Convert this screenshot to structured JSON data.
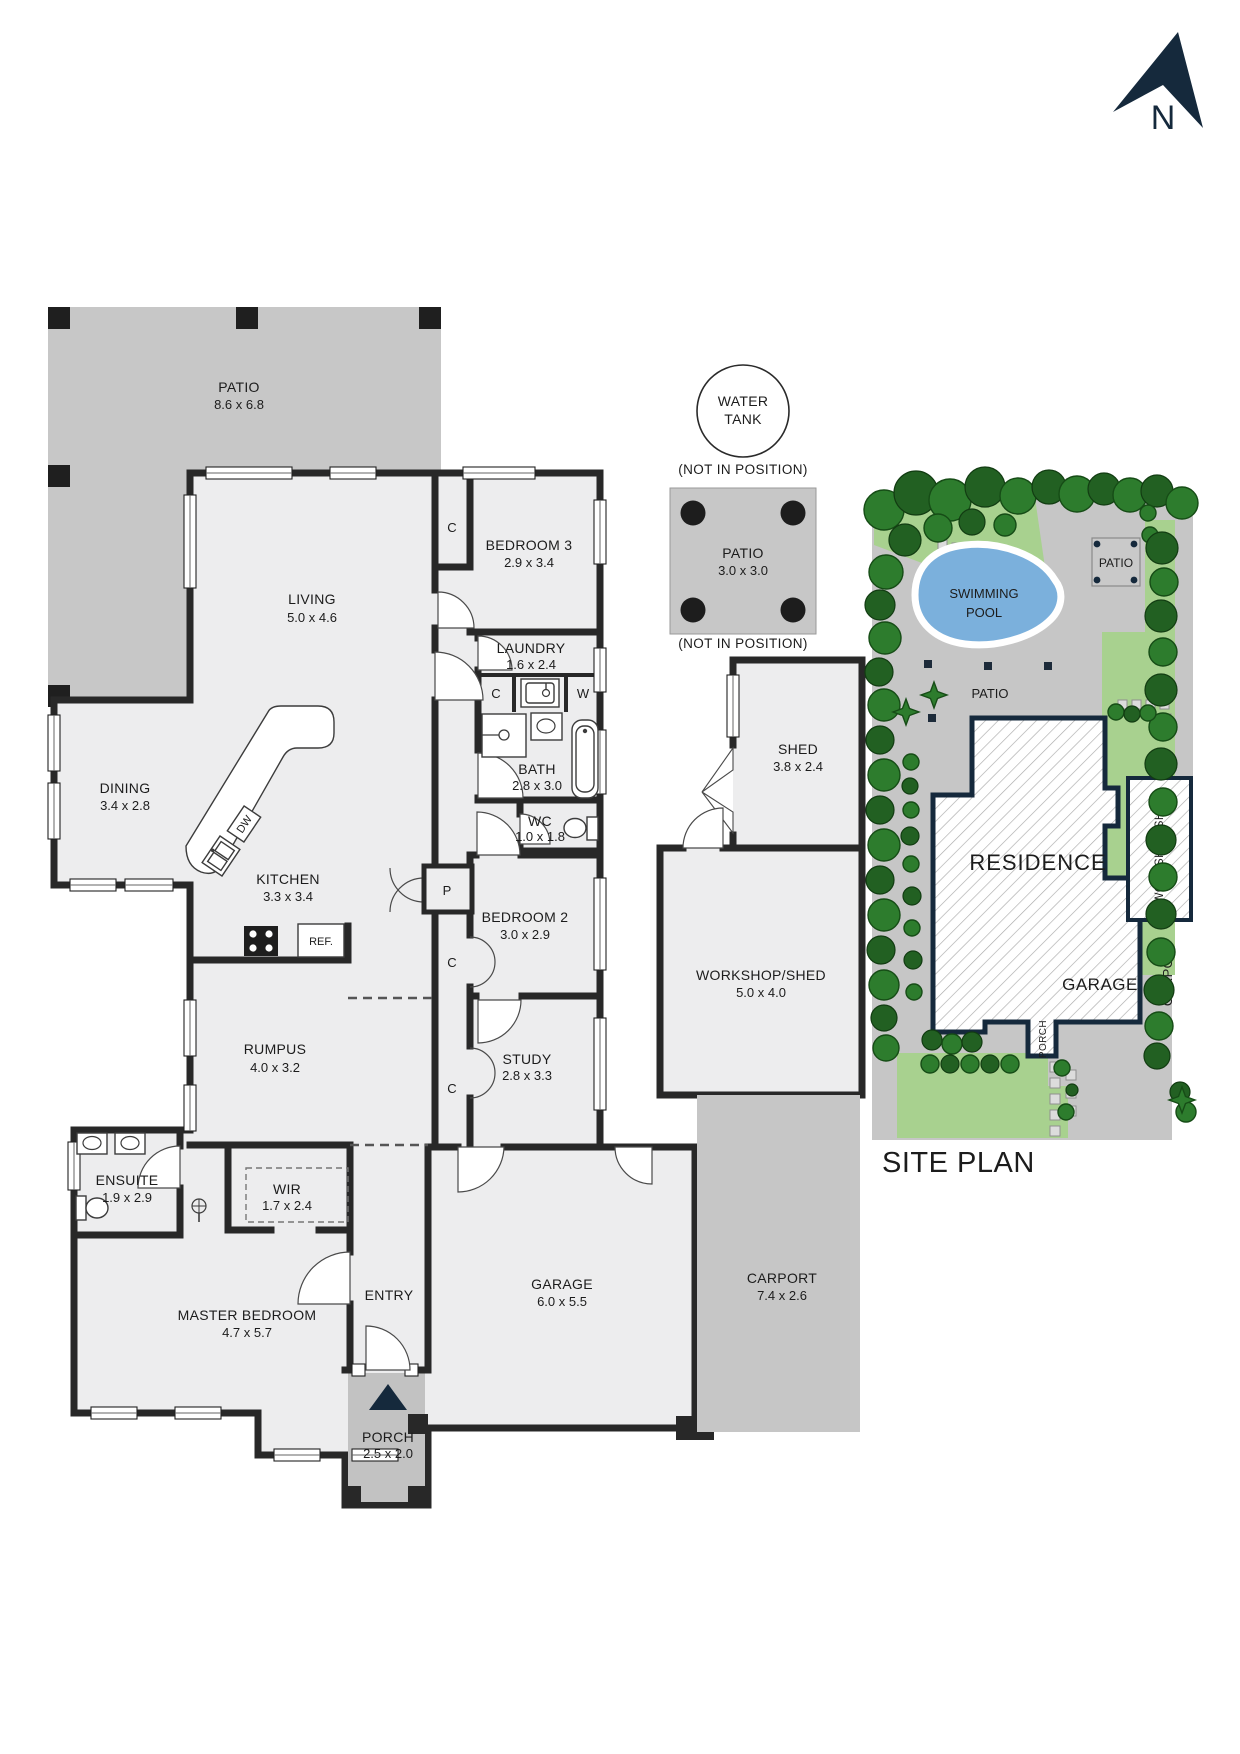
{
  "north": {
    "label": "N"
  },
  "floor_plan": {
    "rooms": {
      "patio_main": {
        "name": "PATIO",
        "dims": "8.6 x 6.8"
      },
      "living": {
        "name": "LIVING",
        "dims": "5.0 x 4.6"
      },
      "bedroom3": {
        "name": "BEDROOM 3",
        "dims": "2.9 x 3.4"
      },
      "laundry": {
        "name": "LAUNDRY",
        "dims": "1.6 x 2.4"
      },
      "dining": {
        "name": "DINING",
        "dims": "3.4 x 2.8"
      },
      "bath": {
        "name": "BATH",
        "dims": "2.8 x 3.0"
      },
      "wc": {
        "name": "WC",
        "dims": "1.0 x 1.8"
      },
      "kitchen": {
        "name": "KITCHEN",
        "dims": "3.3 x 3.4"
      },
      "bedroom2": {
        "name": "BEDROOM 2",
        "dims": "3.0 x 2.9"
      },
      "rumpus": {
        "name": "RUMPUS",
        "dims": "4.0 x 3.2"
      },
      "study": {
        "name": "STUDY",
        "dims": "2.8 x 3.3"
      },
      "ensuite": {
        "name": "ENSUITE",
        "dims": "1.9 x 2.9"
      },
      "wir": {
        "name": "WIR",
        "dims": "1.7 x 2.4"
      },
      "master_bedroom": {
        "name": "MASTER BEDROOM",
        "dims": "4.7 x 5.7"
      },
      "entry": {
        "name": "ENTRY"
      },
      "garage": {
        "name": "GARAGE",
        "dims": "6.0 x 5.5"
      },
      "porch": {
        "name": "PORCH",
        "dims": "2.5 x 2.0"
      },
      "shed": {
        "name": "SHED",
        "dims": "3.8 x 2.4"
      },
      "workshop_shed": {
        "name": "WORKSHOP/SHED",
        "dims": "5.0 x 4.0"
      },
      "carport": {
        "name": "CARPORT",
        "dims": "7.4 x 2.6"
      }
    },
    "fixtures": {
      "closet": "C",
      "washer": "W",
      "pantry": "P",
      "dishwasher": "DW",
      "refrigerator": "REF."
    },
    "water_tank": {
      "line1": "WATER",
      "line2": "TANK",
      "note": "(NOT IN POSITION)"
    },
    "patio_detached": {
      "name": "PATIO",
      "dims": "3.0 x 3.0",
      "note": "(NOT IN POSITION)"
    }
  },
  "site_plan": {
    "title": "SITE PLAN",
    "residence": "RESIDENCE",
    "garage": "GARAGE",
    "workshop_shed": "WORKSHOP/SHED",
    "carport": "CARPORT",
    "porch": "PORCH",
    "swimming_pool": {
      "line1": "SWIMMING",
      "line2": "POOL"
    },
    "patio_rear": "PATIO",
    "patio_court": "PATIO"
  },
  "colors": {
    "wall": "#282828",
    "room_fill": "#ededee",
    "patio_gray": "#c7c7c7",
    "navy": "#15293c",
    "pool_blue": "#7bb0dc",
    "grass_green": "#a8d18f",
    "tree_green": "#2d7c2d",
    "paving_gray": "#c6c6c6"
  }
}
